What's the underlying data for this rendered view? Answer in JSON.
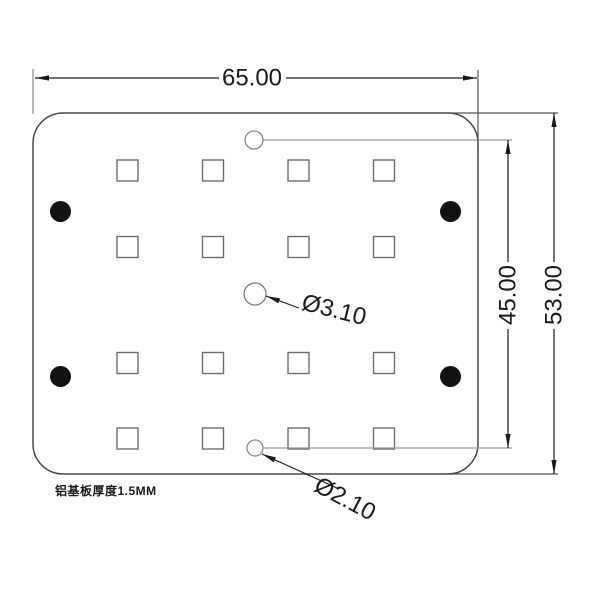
{
  "drawing": {
    "width_dim": "65.00",
    "outer_height_dim": "53.00",
    "inner_height_dim": "45.00",
    "center_hole_dim": "Ø3.10",
    "edge_hole_dim": "Ø2.10",
    "thickness_note": "铝基板厚度1.5MM"
  },
  "structure": {
    "pad_rows": 4,
    "pad_cols": 4,
    "mounting_hole_count": 4,
    "small_hole_count": 3
  },
  "colors": {
    "dimension_ink": "#1a1a1a",
    "plate_outline": "#4a4a4a",
    "pad_outline": "#6e6e6e",
    "extension_gray": "#9a9a9a",
    "hole_fill": "#121212",
    "background": "#ffffff"
  }
}
